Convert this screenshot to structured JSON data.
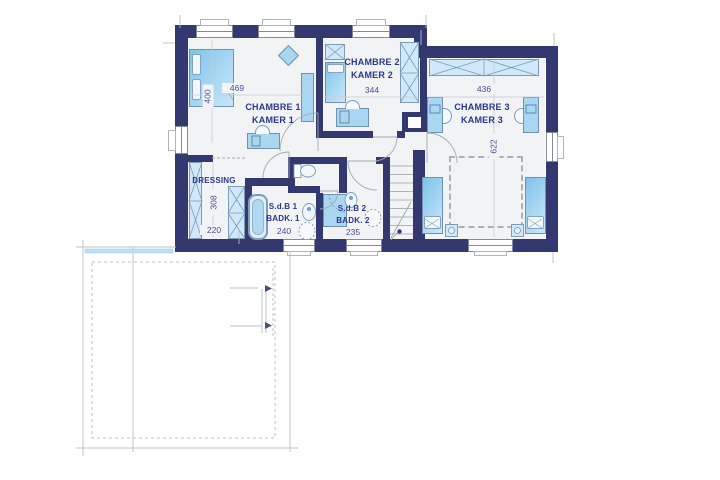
{
  "rooms": {
    "chambre1": {
      "label_fr": "CHAMBRE 1",
      "label_nl": "KAMER 1",
      "dim_width": "469",
      "dim_height": "400"
    },
    "chambre2": {
      "label_fr": "CHAMBRE 2",
      "label_nl": "KAMER 2",
      "dim_width": "344"
    },
    "chambre3": {
      "label_fr": "CHAMBRE 3",
      "label_nl": "KAMER 3",
      "dim_width": "436",
      "dim_height": "622"
    },
    "dressing": {
      "label": "DRESSING",
      "dim_height": "308",
      "dim_width": "220"
    },
    "bathroom1": {
      "label_fr": "S.d.B 1",
      "label_nl": "BADK. 1",
      "dim_width": "240"
    },
    "bathroom2": {
      "label_fr": "S.d.B 2",
      "label_nl": "BADK. 2",
      "dim_width": "235"
    }
  },
  "colors": {
    "wall": "#333870",
    "floor": "#f1f3f5",
    "furniture": "#a9d7f2",
    "furniture_light": "#cfe9fa",
    "room_label": "#2a378c",
    "dimension_text": "#454f8f",
    "outline_gray": "#b6c0ca"
  }
}
